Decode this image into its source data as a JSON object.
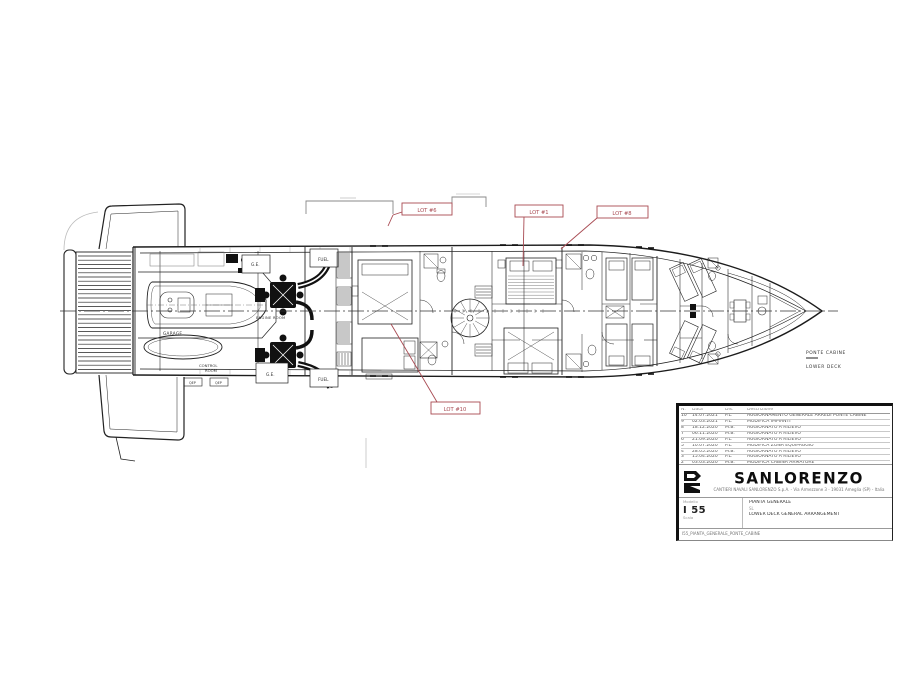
{
  "drawing": {
    "deck_label_primary": "PONTE CABINE",
    "deck_label_secondary": "LOWER DECK",
    "rooms": {
      "garage": "GARAGE",
      "engine_room": "ENGINE ROOM",
      "control_room_line1": "CONTROL",
      "control_room_line2": "ROOM",
      "generator": "G.E.",
      "fuel": "FUEL",
      "qep": "QEP"
    },
    "callouts": [
      {
        "id": "lot6",
        "label": "LOT #6"
      },
      {
        "id": "lot1",
        "label": "LOT #1"
      },
      {
        "id": "lot8",
        "label": "LOT #8"
      },
      {
        "id": "lot10",
        "label": "LOT #10"
      }
    ],
    "accent_color": "#a84a52"
  },
  "titleblock": {
    "logo_text": "SANLORENZO",
    "logo_address": "CANTIERI NAVALI SANLORENZO S.p.A. - Via Armezzone 3 - 19031 Ameglia (SP) - Italia",
    "table_headers": {
      "no": "N.",
      "date": "Data",
      "by": "Dis.",
      "desc": "Descrizione"
    },
    "revisions": [
      {
        "no": "10",
        "date": "14.07.2021",
        "by": "P.L.",
        "desc": "AGGIORNAMENTO GENERALE ARREDI PONTE CABINE"
      },
      {
        "no": "9",
        "date": "02.03.2021",
        "by": "P.L.",
        "desc": "MODIFICA IMPIANTI"
      },
      {
        "no": "8",
        "date": "18.12.2020",
        "by": "M.B.",
        "desc": "AGGIORNATO A RILIEVO"
      },
      {
        "no": "7",
        "date": "06.11.2020",
        "by": "M.B.",
        "desc": "AGGIORNATO A RILIEVO"
      },
      {
        "no": "6",
        "date": "21.09.2020",
        "by": "P.L.",
        "desc": "AGGIORNATO A RILIEVO"
      },
      {
        "no": "5",
        "date": "10.07.2020",
        "by": "P.L.",
        "desc": "MODIFICA ZONA EQUIPAGGIO"
      },
      {
        "no": "4",
        "date": "28.05.2020",
        "by": "M.B.",
        "desc": "AGGIORNATO A RILIEVO"
      },
      {
        "no": "3",
        "date": "15.04.2020",
        "by": "P.L.",
        "desc": "AGGIORNATO A RILIEVO"
      },
      {
        "no": "2",
        "date": "03.03.2020",
        "by": "M.B.",
        "desc": "MODIFICA CABINA ARMATORE"
      },
      {
        "no": "1",
        "date": "20.01.2020",
        "by": "P.L.",
        "desc": "PRIMA EMISSIONE"
      }
    ],
    "project_label": "Modello",
    "project_value": "I 55",
    "scale_label": "Scala",
    "title_line1": "PIANTA GENERALE",
    "title_line2": "SL",
    "title_line3": "LOWER DECK GENERAL ARRANGEMENT",
    "file_ref": "I55_PIANTA_GENERALE_PONTE_CABINE"
  }
}
